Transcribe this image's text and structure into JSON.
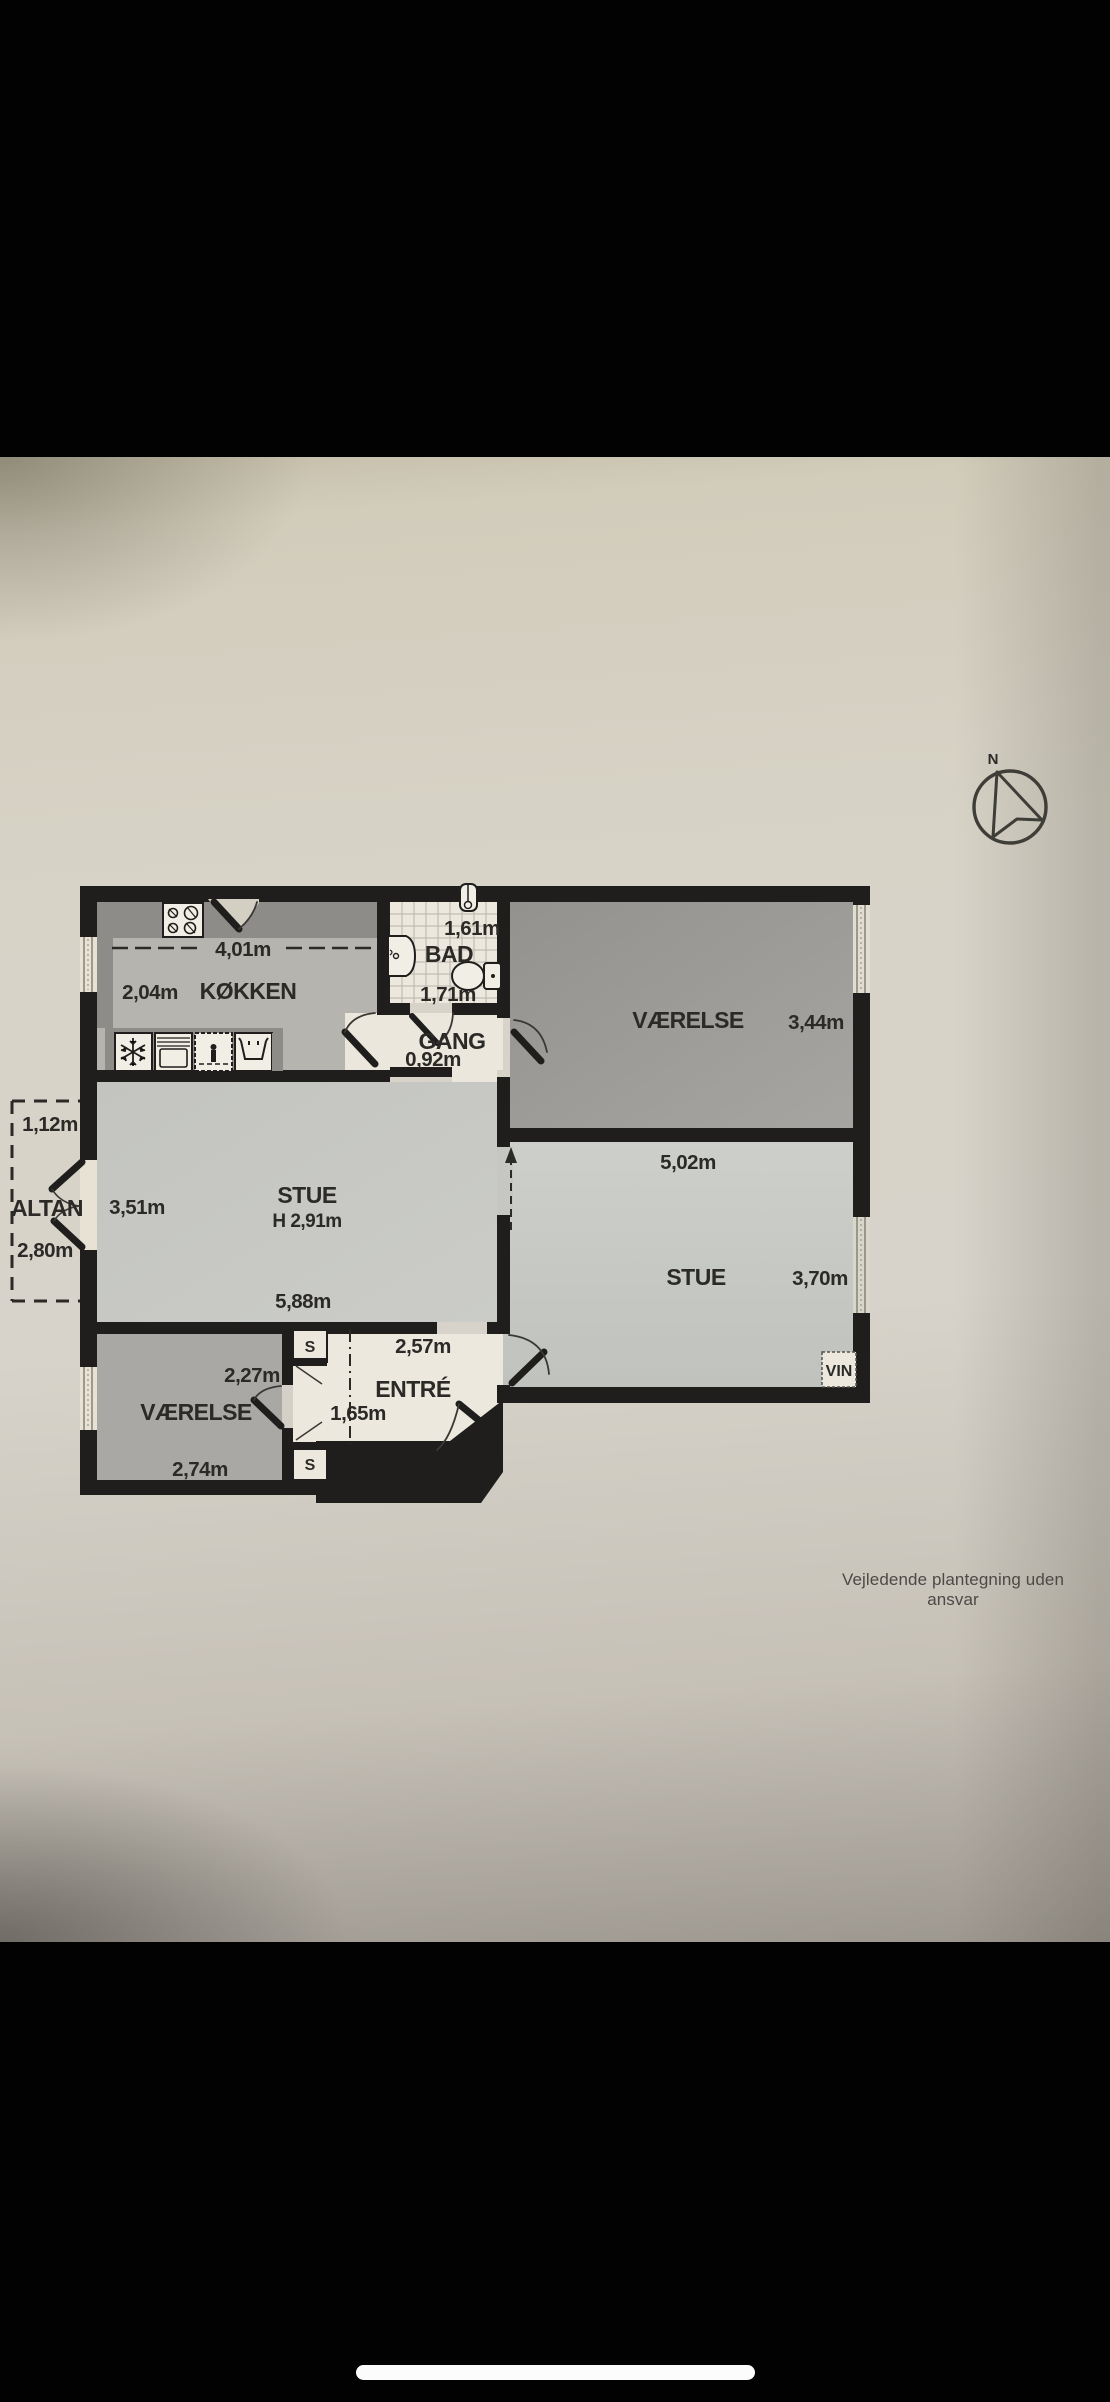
{
  "phone": {
    "home_indicator": true
  },
  "floorplan": {
    "footer": "Vejledende plantegning uden ansvar",
    "compass": {
      "north_label": "N"
    },
    "rooms": {
      "koekken": {
        "name": "KØKKEN",
        "dim_width": "4,01m",
        "dim_depth": "2,04m"
      },
      "bad": {
        "name": "BAD",
        "dim_width": "1,61m",
        "dim_depth": "1,71m"
      },
      "gang": {
        "name": "GANG",
        "dim_width": "0,92m"
      },
      "vaerelse_ne": {
        "name": "VÆRELSE",
        "dim_width": "3,44m"
      },
      "stue_e": {
        "name": "STUE",
        "dim_width": "5,02m",
        "dim_depth": "3,70m",
        "window_label": "VIN"
      },
      "stue_w": {
        "name": "STUE",
        "ceiling_height": "H 2,91m",
        "dim_width": "5,88m",
        "dim_depth": "3,51m"
      },
      "altan": {
        "name": "ALTAN",
        "dim_depth": "1,12m",
        "dim_width": "2,80m"
      },
      "entre": {
        "name": "ENTRÉ",
        "dim_width": "2,57m",
        "dim_inner": "1,65m"
      },
      "vaerelse_sw": {
        "name": "VÆRELSE",
        "dim_width": "2,74m",
        "dim_closet": "2,27m"
      },
      "closet_top": {
        "label": "S"
      },
      "closet_bottom": {
        "label": "S"
      }
    },
    "colors": {
      "wall": "#1f1e1c",
      "paper": "#d7d3c9",
      "floor_light": "#c7c8c4",
      "floor_mid": "#b6b4af",
      "floor_dark": "#9c9b99",
      "floor_sw": "#a9a8a5",
      "tile_floor": "#ece8dd",
      "counter": "#8e8c88"
    }
  }
}
